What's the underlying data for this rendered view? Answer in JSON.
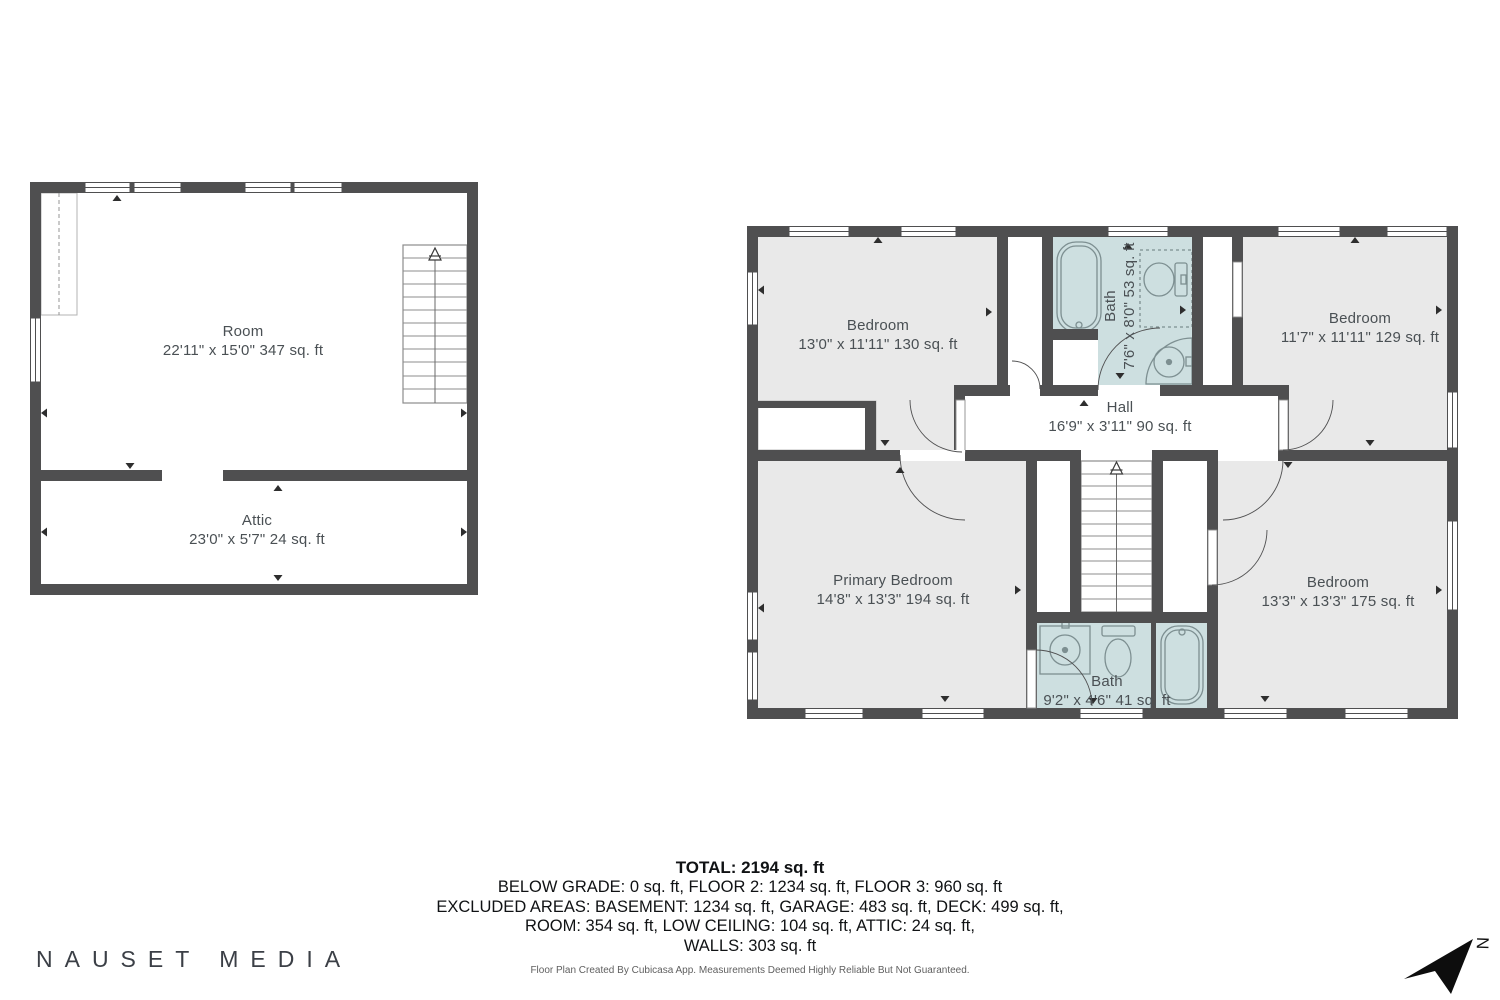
{
  "plans": {
    "left": {
      "rooms": [
        {
          "name": "Room",
          "dims": "22'11\" x 15'0\" 347 sq. ft"
        },
        {
          "name": "Attic",
          "dims": "23'0\" x 5'7\" 24 sq. ft"
        }
      ]
    },
    "right": {
      "rooms": [
        {
          "name": "Bedroom",
          "dims": "13'0\" x 11'11\" 130 sq. ft"
        },
        {
          "name": "Bath",
          "dims": "7'6\" x 8'0\" 53 sq. ft"
        },
        {
          "name": "Bedroom",
          "dims": "11'7\" x 11'11\" 129 sq. ft"
        },
        {
          "name": "Hall",
          "dims": "16'9\" x 3'11\" 90 sq. ft"
        },
        {
          "name": "Primary Bedroom",
          "dims": "14'8\" x 13'3\" 194 sq. ft"
        },
        {
          "name": "Bath",
          "dims": "9'2\" x 4'6\" 41 sq. ft"
        },
        {
          "name": "Bedroom",
          "dims": "13'3\" x 13'3\" 175 sq. ft"
        }
      ]
    }
  },
  "summary": {
    "total": "TOTAL: 2194 sq. ft",
    "line1": "BELOW GRADE: 0 sq. ft, FLOOR 2: 1234 sq. ft, FLOOR 3: 960 sq. ft",
    "line2": "EXCLUDED AREAS: BASEMENT: 1234 sq. ft, GARAGE: 483 sq. ft, DECK: 499 sq. ft,",
    "line3": "ROOM: 354 sq. ft, LOW CEILING: 104 sq. ft, ATTIC: 24 sq. ft,",
    "line4": "WALLS: 303 sq. ft",
    "disclaimer": "Floor Plan Created By Cubicasa App. Measurements Deemed Highly Reliable But Not Guaranteed."
  },
  "branding": {
    "logo": "NAUSET MEDIA",
    "compass_label": "N"
  },
  "colors": {
    "wall": "#4f4f50",
    "room_fill": "#e9e9e9",
    "bath_fill": "#cddfe0",
    "fixture_stroke": "#7d8f91",
    "label_text": "#4a5054"
  }
}
